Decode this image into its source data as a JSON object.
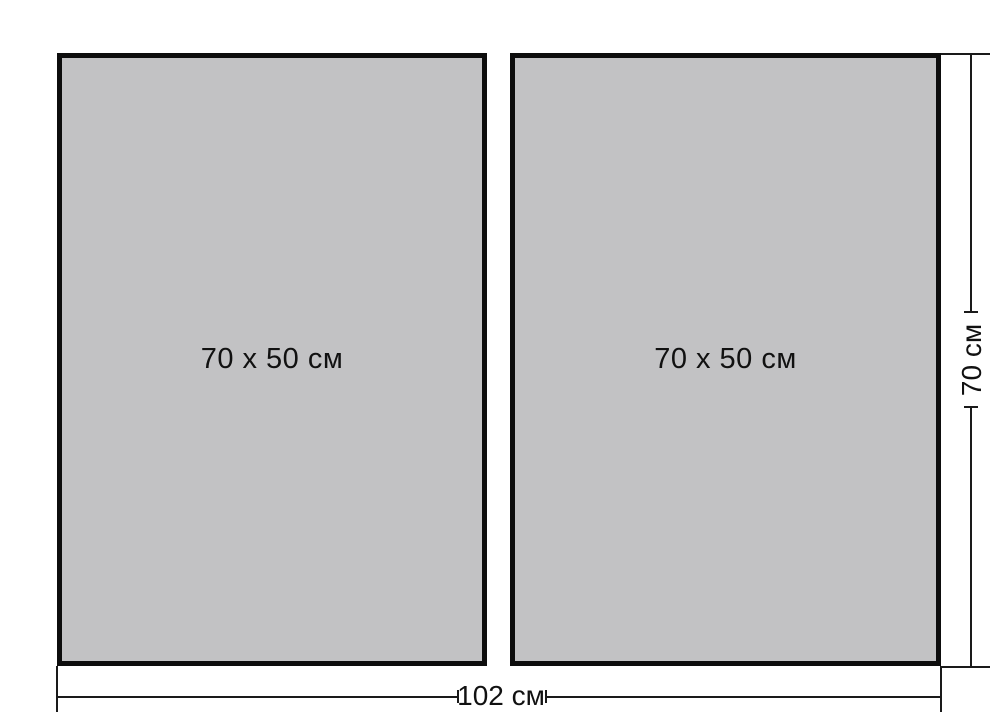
{
  "figure": {
    "panels": [
      {
        "label": "70 x 50 см"
      },
      {
        "label": "70 x 50 см"
      }
    ],
    "dimensions": {
      "total_width_label": "102 см",
      "total_height_label": "70 см"
    },
    "colors": {
      "background": "#ffffff",
      "panel_fill": "#c2c2c4",
      "panel_border": "#0d0d0d",
      "line": "#1a1a1a",
      "text": "#111111"
    }
  }
}
